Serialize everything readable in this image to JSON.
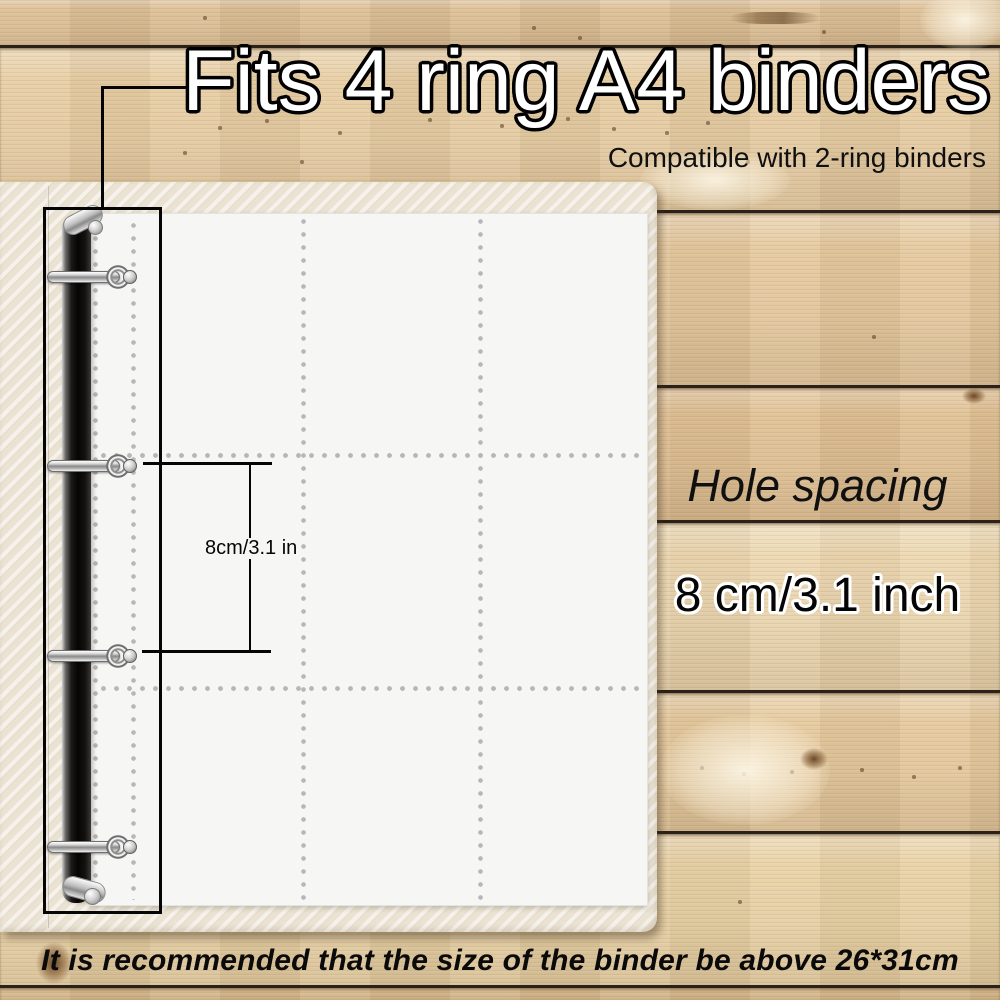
{
  "title": {
    "text": "Fits 4 ring A4 binders"
  },
  "subtitle": {
    "text": "Compatible with 2-ring binders"
  },
  "dimension_callout": {
    "label": "8cm/3.1 in"
  },
  "hole_spacing": {
    "heading": "Hole spacing",
    "value": "8 cm/3.1 inch"
  },
  "footer": {
    "note": "It is recommended that the size of the binder be above 26*31cm"
  },
  "binder": {
    "ring_count": 4,
    "ring_centers_y": [
      277,
      466,
      656,
      847
    ],
    "hole_dot_columns_x": [
      95,
      133
    ],
    "pocket_seam_columns_x": [
      303,
      480
    ],
    "pocket_seam_rows_y": [
      455,
      688
    ],
    "pocket_grid": {
      "rows": 3,
      "columns": 3
    },
    "page_rect": {
      "left": 89,
      "top": 213,
      "width": 559,
      "height": 693
    },
    "cover_rect": {
      "left": 0,
      "top": 182,
      "width": 657,
      "height": 750
    }
  },
  "annotation_geometry": {
    "callout_box": {
      "left": 43,
      "top": 207,
      "width": 119,
      "height": 707
    },
    "leader_corner": {
      "x": 101,
      "y": 86
    },
    "leader_end_x": 190,
    "dim_ticks_y": [
      462,
      650
    ],
    "dim_tick_left_x": 143,
    "dim_tick_width": 129,
    "dim_line_x": 249,
    "dim_label_center": {
      "x": 253,
      "y": 549
    }
  },
  "colors": {
    "wood_planks": [
      "#dcbf95",
      "#e7cda3",
      "#e5c99e",
      "#e0c093",
      "#ecd7b0",
      "#e5c99d",
      "#e9d2a6",
      "#d8ba8c"
    ],
    "plank_gap": "#2a2118",
    "cover": "#eae2d2",
    "page": "#f6f6f5",
    "grid_dots": "#b7b7b7",
    "ink": "#050505",
    "title_fill": "#ffffff",
    "title_outline": "#000000",
    "body_text": "#101010",
    "spine": "#141210",
    "metal_dark": "#6e6e6e"
  }
}
